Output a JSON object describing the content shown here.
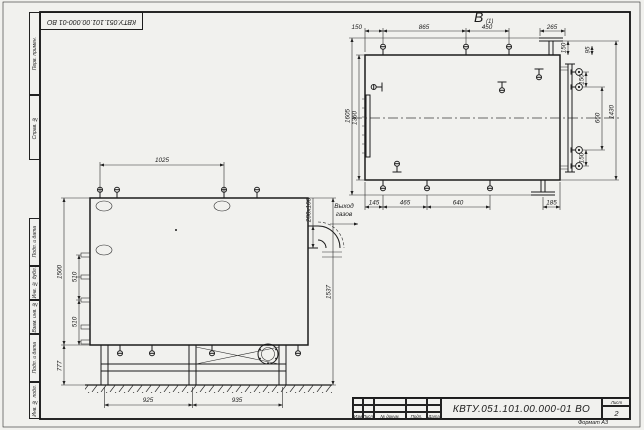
{
  "sheet": {
    "designation": "КВТУ.051.101.00.000-01 ВО",
    "flipped_designation": "КВТУ.051.101.00.000-01 ВО",
    "format_note": "Формат А3",
    "stamp": {
      "designation": "КВТУ.051.101.00.000-01 ВО",
      "col_izm": "Изм",
      "col_list": "Лист",
      "col_doc": "№ докум.",
      "col_podp": "Подп.",
      "col_data": "Дата",
      "sheet_label": "Лист",
      "sheet_number": "2"
    },
    "margin": {
      "perv": "Перв. примен.",
      "sprav": "Справ. №",
      "podp1": "Подп. и дата",
      "inv_dubl": "Инв. № дубл.",
      "vzam": "Взам. инв. №",
      "podp2": "Подп. и дата",
      "inv_podl": "Инв. № подл."
    }
  },
  "views": {
    "label": "В",
    "label_sub": "(1)",
    "front": {
      "dim_top": "1025",
      "dim_left_overall": "1500",
      "dim_left_a": "510",
      "dim_left_b": "510",
      "dim_left_bottom": "777",
      "dim_right": "1537",
      "dim_bottom_a": "925",
      "dim_bottom_b": "935",
      "duct_size": "200х100",
      "gas_outlet_line1": "Выход",
      "gas_outlet_line2": "газов"
    },
    "plan": {
      "dim_top_1": "150",
      "dim_top_2": "865",
      "dim_top_3": "450",
      "dim_top_4": "265",
      "dim_top_right_a": "150",
      "dim_top_right_b": "95",
      "dim_left_overall": "1605",
      "dim_left_inner": "1360",
      "dim_right_a": "150",
      "dim_right_b": "660",
      "dim_right_c": "150",
      "dim_right_overall": "1430",
      "dim_bottom_1": "145",
      "dim_bottom_2": "465",
      "dim_bottom_3": "640",
      "dim_bottom_4": "185"
    }
  }
}
